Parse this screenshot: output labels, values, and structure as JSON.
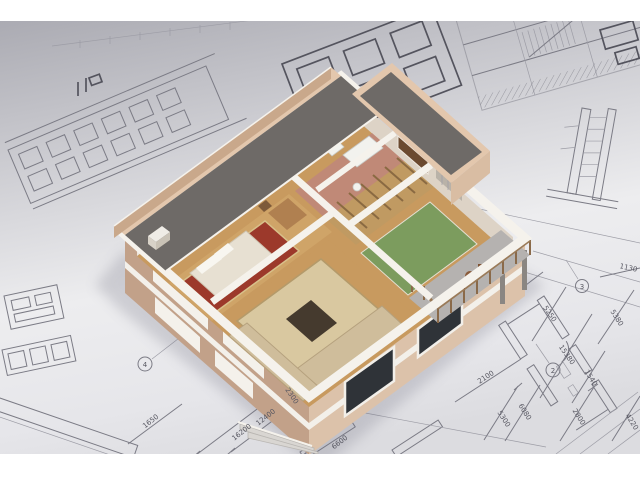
{
  "scene": {
    "type": "3d-architectural-visualization",
    "subject": "cutaway two-story house 3D model standing on perspective blueprint drawings"
  },
  "house": {
    "rooms": [
      "bedroom",
      "living-room",
      "bathroom",
      "stair-hall",
      "games-room",
      "terrace"
    ],
    "colors": {
      "roof": "#6e6a67",
      "parapet": "#e3c7ad",
      "wall_shaded": "#c2a189",
      "wall_lit": "#dcc2aa",
      "trim": "#f5f2ec",
      "wood_floor": "#c89a5f",
      "bedroom_rug": "#9c392b",
      "living_rug": "#d9c8a0",
      "games_rug": "#7c9c5e",
      "bathroom_floor": "#c08977",
      "sofa": "#cfbd9b"
    }
  },
  "blueprint": {
    "ink": "#7b7b85",
    "bold_ink": "#54545e",
    "paper_top": "#a8a8b0",
    "paper_center": "#efeff1",
    "dimensions": [
      {
        "label": "1650"
      },
      {
        "label": "16200"
      },
      {
        "label": "12400"
      },
      {
        "label": "2300"
      },
      {
        "label": "6600"
      },
      {
        "label": "2100"
      },
      {
        "label": "5300"
      },
      {
        "label": "6080"
      },
      {
        "label": "2800"
      },
      {
        "label": "4220"
      },
      {
        "label": "15380"
      },
      {
        "label": "1540"
      },
      {
        "label": "5250"
      },
      {
        "label": "5380"
      },
      {
        "label": "1130"
      }
    ],
    "grid_bubbles": [
      {
        "label": "4"
      },
      {
        "label": "2"
      },
      {
        "label": "3"
      }
    ]
  }
}
